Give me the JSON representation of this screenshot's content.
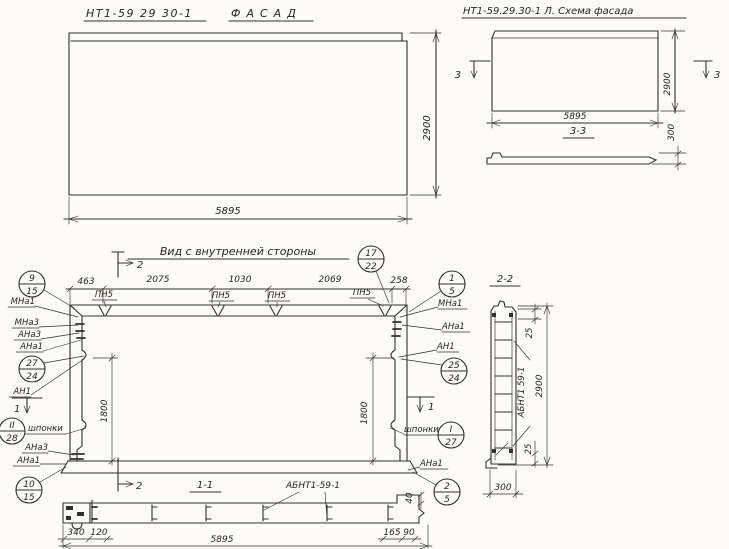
{
  "facade": {
    "code": "НТ1-59 29 30-1",
    "title": "ФАСАД",
    "dim_width": "5895",
    "dim_height": "2900"
  },
  "scheme": {
    "title": "НТ1-59.29.30-1 Л.  Схема фасада",
    "dim_width": "5895",
    "dim_height": "2900",
    "cut_label": "3",
    "section_title": "3-3",
    "dim_thickness": "300"
  },
  "inner": {
    "title": "Вид с внутренней стороны",
    "dim_segments": [
      "463",
      "2075",
      "1030",
      "2069",
      "258"
    ],
    "pn_label": "ПН5",
    "dim_side": "1800",
    "cut1": "1",
    "cut2": "2",
    "labels": {
      "mna1": "МНа1",
      "mna3": "МНа3",
      "ana3": "АНа3",
      "ana1": "АНа1",
      "an1": "АН1",
      "shponki": "шпонки"
    },
    "callouts": {
      "c_9_15": {
        "top": "9",
        "bottom": "15"
      },
      "c_17_22": {
        "top": "17",
        "bottom": "22"
      },
      "c_1_5": {
        "top": "1",
        "bottom": "5"
      },
      "c_27_24": {
        "top": "27",
        "bottom": "24"
      },
      "c_25_24": {
        "top": "25",
        "bottom": "24"
      },
      "c_II_28": {
        "top": "II",
        "bottom": "28"
      },
      "c_I_27": {
        "top": "I",
        "bottom": "27"
      },
      "c_10_15": {
        "top": "10",
        "bottom": "15"
      },
      "c_2_5": {
        "top": "2",
        "bottom": "5"
      }
    }
  },
  "section11": {
    "title": "1-1",
    "part_label": "АБНТ1-59-1",
    "dims": {
      "d340": "340",
      "d120": "120",
      "d165": "165",
      "d90": "90",
      "d40": "40",
      "total": "5895"
    }
  },
  "section22": {
    "title": "2-2",
    "part_label": "АБНТ1 59-1",
    "dims": {
      "top": "25",
      "bottom": "25",
      "height": "2900",
      "width": "300"
    }
  }
}
